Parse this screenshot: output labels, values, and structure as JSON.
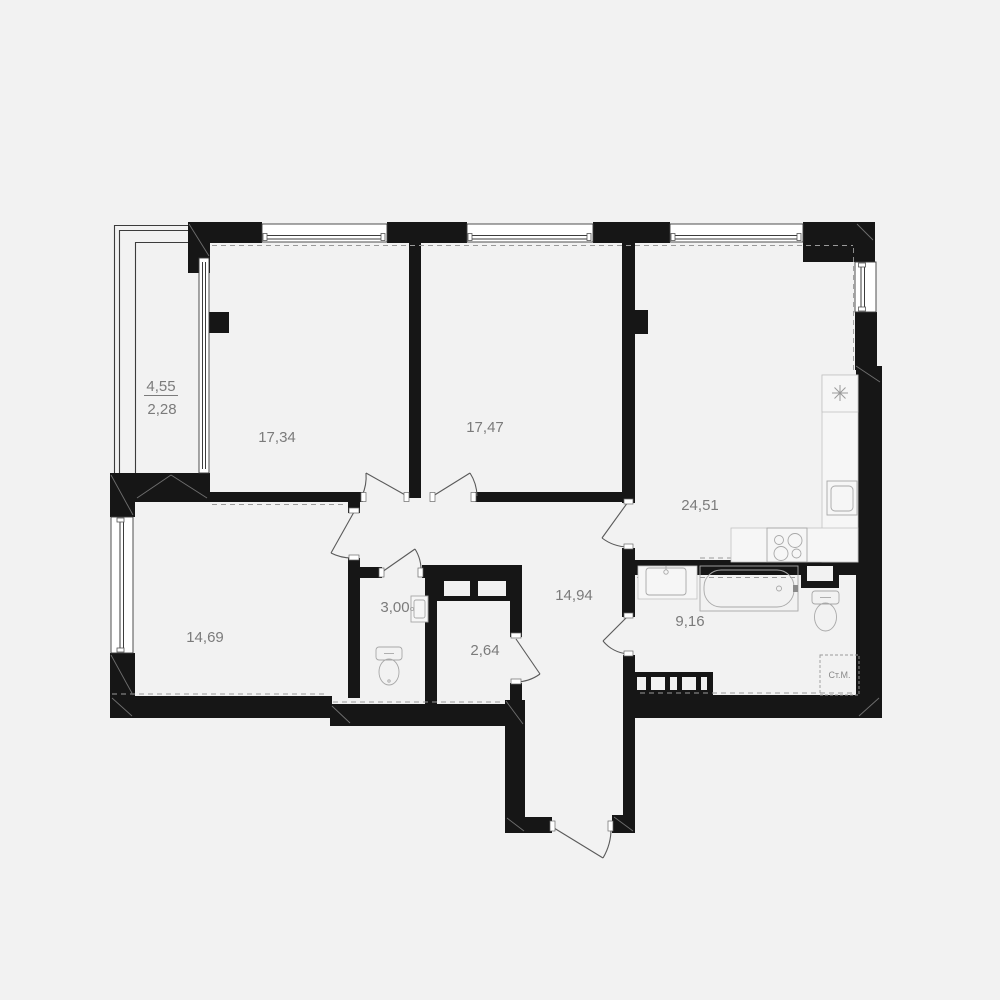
{
  "plan": {
    "type": "apartment-floor-plan",
    "background_color": "#f2f2f2",
    "wall_color": "#161616",
    "label_color": "#7b7b7b",
    "rooms": [
      {
        "id": "balcony",
        "area": "4,55",
        "area_reduced": "2,28"
      },
      {
        "id": "room-top-left",
        "area": "17,34"
      },
      {
        "id": "room-top-mid",
        "area": "17,47"
      },
      {
        "id": "kitchen-living",
        "area": "24,51"
      },
      {
        "id": "hallway",
        "area": "14,94"
      },
      {
        "id": "room-bottom-left",
        "area": "14,69"
      },
      {
        "id": "wc",
        "area": "3,00"
      },
      {
        "id": "storage",
        "area": "2,64"
      },
      {
        "id": "bathroom",
        "area": "9,16"
      }
    ],
    "appliances": {
      "washing_machine": "Ст.М."
    }
  }
}
